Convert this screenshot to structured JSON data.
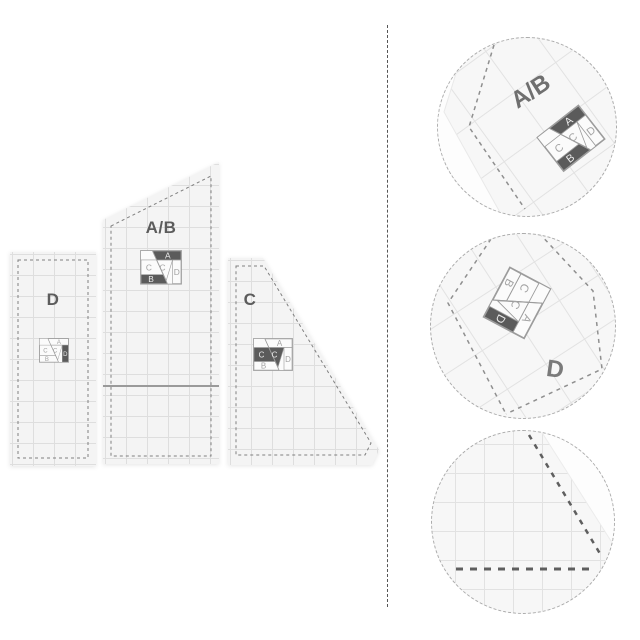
{
  "product": {
    "templates": [
      {
        "id": "d",
        "label": "D"
      },
      {
        "id": "ab",
        "label": "A/B"
      },
      {
        "id": "c",
        "label": "C"
      }
    ],
    "detail_circles": [
      {
        "label": "A/B"
      },
      {
        "label": "D"
      },
      {
        "label": ""
      }
    ]
  },
  "logo": {
    "letters": {
      "a": "A",
      "b": "B",
      "c1": "C",
      "c2": "C",
      "d": "D"
    },
    "palette": {
      "dark": "#5b5b5b",
      "letter_on_dark": "#ececec",
      "letter_on_light": "#a3a3a3",
      "frame": "#9c9c9c"
    },
    "variants": {
      "ab": {
        "a": "dark",
        "b": "dark",
        "c1": "light",
        "c2": "light",
        "d": "light"
      },
      "d": {
        "a": "light",
        "b": "light",
        "c1": "light",
        "c2": "light",
        "d": "dark"
      },
      "c": {
        "a": "light",
        "b": "light",
        "c1": "dark",
        "c2": "dark",
        "d": "light"
      }
    }
  },
  "colors": {
    "background": "#ffffff",
    "template_fill": "#f4f4f4",
    "grid_line": "#dedede",
    "seam_dash": "#7f7f7f",
    "label_text": "#5c5c5c",
    "divider": "#565656",
    "circle_border": "#ababab",
    "logo_dark": "#5b5b5b"
  }
}
